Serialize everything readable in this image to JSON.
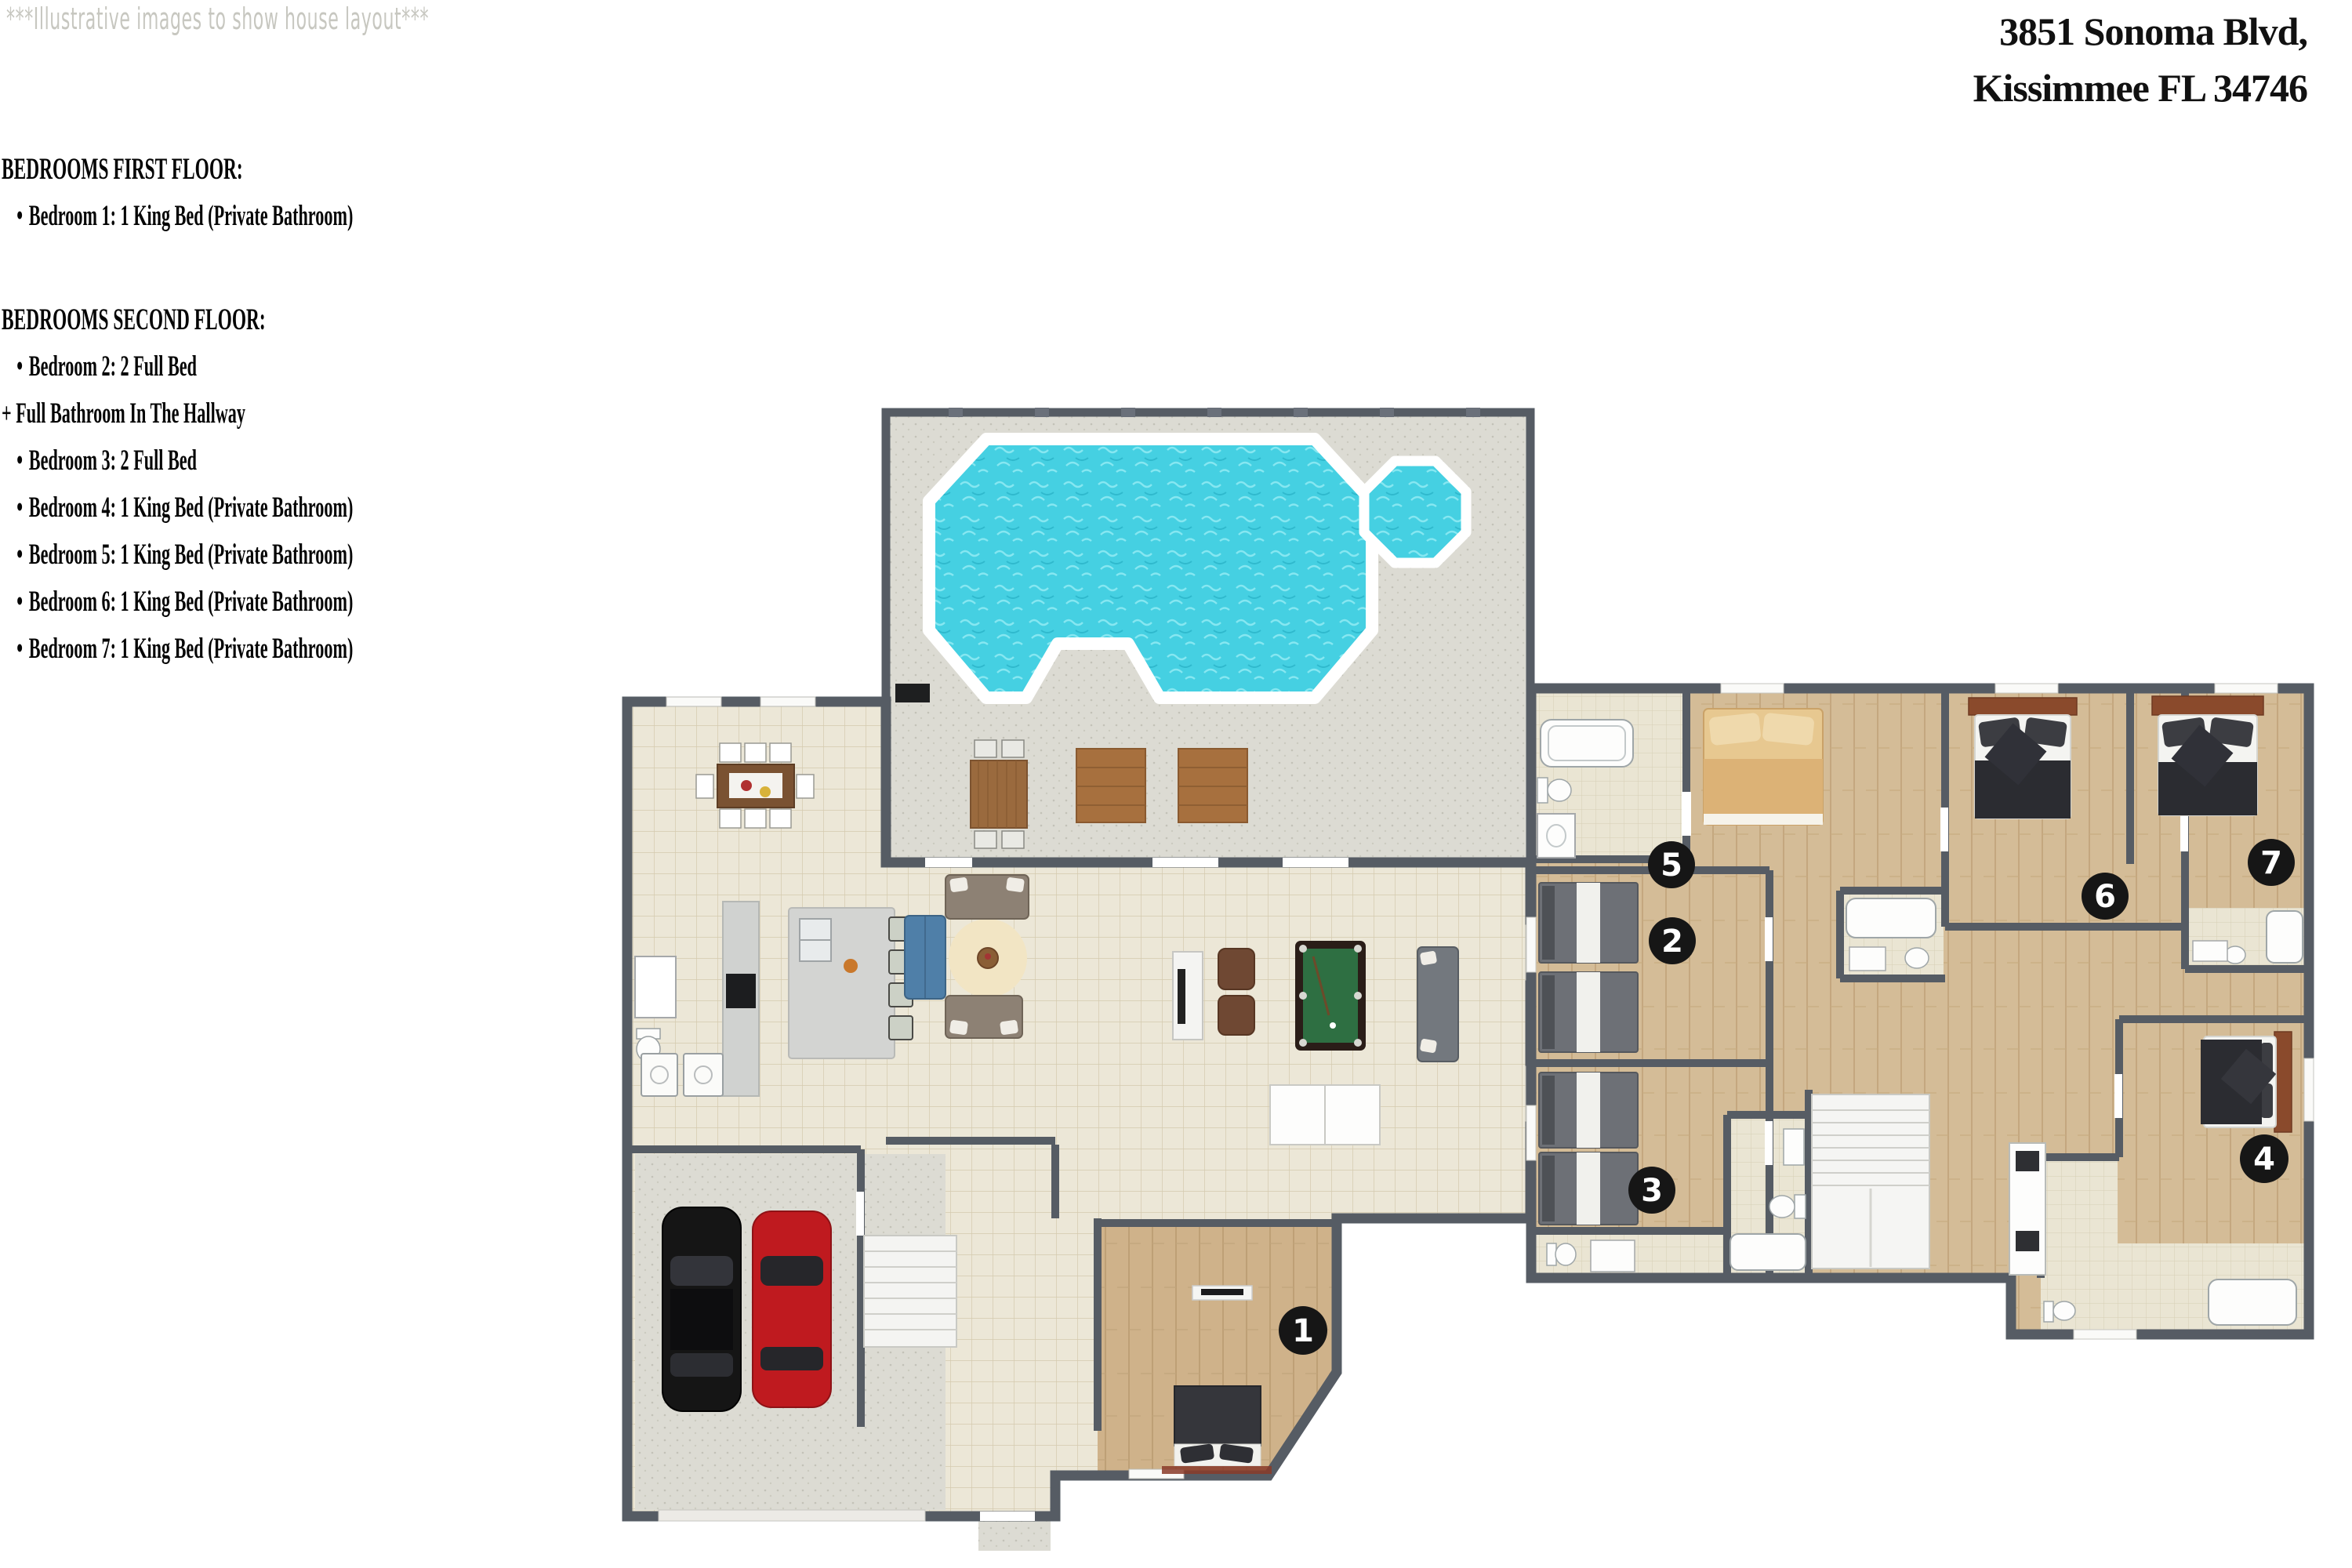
{
  "watermark": "***Illustrative images to show house layout***",
  "address": {
    "line1": "3851 Sonoma Blvd,",
    "line2": "Kissimmee FL 34746"
  },
  "first_floor": {
    "heading": "BEDROOMS FIRST FLOOR:",
    "items": [
      "Bedroom 1: 1 King Bed (Private Bathroom)"
    ]
  },
  "second_floor": {
    "heading": "BEDROOMS SECOND FLOOR:",
    "items_top": [
      "Bedroom 2: 2 Full Bed"
    ],
    "note": "+ Full Bathroom In The Hallway",
    "items": [
      "Bedroom 3: 2 Full Bed",
      "Bedroom 4: 1 King Bed (Private Bathroom)",
      "Bedroom 5: 1 King Bed (Private Bathroom)",
      "Bedroom 6: 1 King Bed (Private Bathroom)",
      "Bedroom 7: 1 King Bed (Private Bathroom)"
    ]
  },
  "badges": {
    "b1": "1",
    "b2": "2",
    "b3": "3",
    "b4": "4",
    "b5": "5",
    "b6": "6",
    "b7": "7"
  },
  "colors": {
    "wall": "#565c64",
    "floor_tile": "#ece7d7",
    "wood_floor": "#cfb28a",
    "bath_tile": "#eae5d3",
    "patio_gray": "#dcdbd3",
    "pool_water": "#45d0e2",
    "pool_coping": "#ffffff",
    "badge": "#161616",
    "car_black": "#151515",
    "car_red": "#bf1a1f",
    "pool_table_felt": "#2e6f42",
    "sofa_taupe": "#8d8174",
    "sofa_blue": "#4f7fa8",
    "bed_dark": "#2b2c31",
    "bed_tan": "#e7c890",
    "headboard_brown": "#8a4a2c"
  }
}
